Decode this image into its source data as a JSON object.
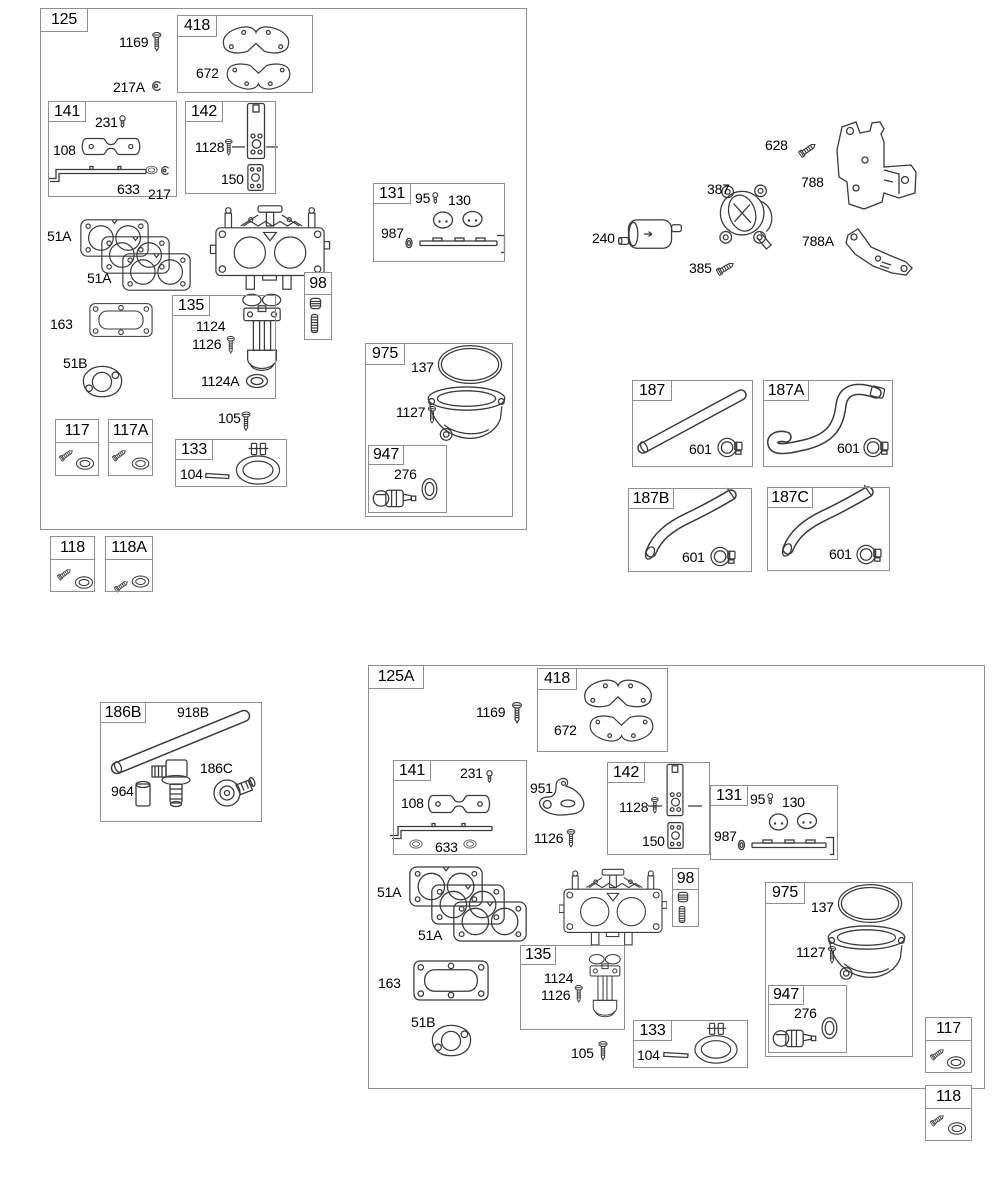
{
  "colors": {
    "background": "#ffffff",
    "line_art": "#3a3a3a",
    "box_border": "#8f8f8f",
    "text": "#000000"
  },
  "boxes": [
    {
      "id": "125",
      "tag": "125",
      "x": 40,
      "y": 8,
      "w": 487,
      "h": 522,
      "tw": 48,
      "th": 24
    },
    {
      "id": "418-top",
      "tag": "418",
      "x": 177,
      "y": 15,
      "w": 136,
      "h": 78,
      "tw": 40,
      "th": 22
    },
    {
      "id": "141-top",
      "tag": "141",
      "x": 48,
      "y": 101,
      "w": 129,
      "h": 96,
      "tw": 38,
      "th": 21
    },
    {
      "id": "142-top",
      "tag": "142",
      "x": 185,
      "y": 101,
      "w": 91,
      "h": 93,
      "tw": 38,
      "th": 21
    },
    {
      "id": "131-top",
      "tag": "131",
      "x": 373,
      "y": 183,
      "w": 132,
      "h": 79,
      "tw": 38,
      "th": 21
    },
    {
      "id": "98-top",
      "tag": "98",
      "x": 304,
      "y": 272,
      "w": 28,
      "h": 68,
      "th": 23,
      "full": true
    },
    {
      "id": "135-top",
      "tag": "135",
      "x": 172,
      "y": 295,
      "w": 104,
      "h": 104,
      "tw": 38,
      "th": 21
    },
    {
      "id": "975-top",
      "tag": "975",
      "x": 365,
      "y": 343,
      "w": 148,
      "h": 174,
      "tw": 40,
      "th": 22
    },
    {
      "id": "947-top",
      "tag": "947",
      "x": 368,
      "y": 445,
      "w": 79,
      "h": 68,
      "tw": 36,
      "th": 20
    },
    {
      "id": "117-top",
      "tag": "117",
      "x": 55,
      "y": 419,
      "w": 44,
      "h": 57,
      "th": 24,
      "full": true
    },
    {
      "id": "117A-top",
      "tag": "117A",
      "x": 108,
      "y": 419,
      "w": 45,
      "h": 57,
      "th": 24,
      "full": true
    },
    {
      "id": "133-top",
      "tag": "133",
      "x": 175,
      "y": 439,
      "w": 112,
      "h": 48,
      "tw": 38,
      "th": 21
    },
    {
      "id": "118-left",
      "tag": "118",
      "x": 50,
      "y": 536,
      "w": 45,
      "h": 56,
      "th": 24,
      "full": true
    },
    {
      "id": "118A-left",
      "tag": "118A",
      "x": 105,
      "y": 536,
      "w": 48,
      "h": 56,
      "th": 24,
      "full": true
    },
    {
      "id": "187",
      "tag": "187",
      "x": 632,
      "y": 380,
      "w": 121,
      "h": 87,
      "tw": 40,
      "th": 21
    },
    {
      "id": "187A",
      "tag": "187A",
      "x": 763,
      "y": 380,
      "w": 130,
      "h": 87,
      "tw": 46,
      "th": 21
    },
    {
      "id": "187B",
      "tag": "187B",
      "x": 628,
      "y": 488,
      "w": 124,
      "h": 84,
      "tw": 46,
      "th": 21
    },
    {
      "id": "187C",
      "tag": "187C",
      "x": 767,
      "y": 487,
      "w": 123,
      "h": 84,
      "tw": 46,
      "th": 21
    },
    {
      "id": "186B",
      "tag": "186B",
      "x": 100,
      "y": 702,
      "w": 162,
      "h": 120,
      "tw": 46,
      "th": 21
    },
    {
      "id": "125A",
      "tag": "125A",
      "x": 368,
      "y": 665,
      "w": 617,
      "h": 424,
      "tw": 56,
      "th": 24
    },
    {
      "id": "418-bottom",
      "tag": "418",
      "x": 537,
      "y": 668,
      "w": 131,
      "h": 84,
      "tw": 40,
      "th": 22
    },
    {
      "id": "141-bottom",
      "tag": "141",
      "x": 393,
      "y": 760,
      "w": 134,
      "h": 95,
      "tw": 38,
      "th": 21
    },
    {
      "id": "142-bottom",
      "tag": "142",
      "x": 607,
      "y": 762,
      "w": 103,
      "h": 93,
      "tw": 38,
      "th": 21
    },
    {
      "id": "131-bottom",
      "tag": "131",
      "x": 710,
      "y": 785,
      "w": 128,
      "h": 75,
      "tw": 38,
      "th": 21
    },
    {
      "id": "98-bottom",
      "tag": "98",
      "x": 672,
      "y": 868,
      "w": 27,
      "h": 59,
      "th": 22,
      "full": true
    },
    {
      "id": "135-bottom",
      "tag": "135",
      "x": 520,
      "y": 945,
      "w": 105,
      "h": 85,
      "tw": 36,
      "th": 20
    },
    {
      "id": "133-bottom",
      "tag": "133",
      "x": 633,
      "y": 1020,
      "w": 115,
      "h": 48,
      "tw": 39,
      "th": 21
    },
    {
      "id": "975-bottom",
      "tag": "975",
      "x": 765,
      "y": 882,
      "w": 148,
      "h": 175,
      "tw": 40,
      "th": 22
    },
    {
      "id": "947-bottom",
      "tag": "947",
      "x": 768,
      "y": 985,
      "w": 79,
      "h": 68,
      "tw": 36,
      "th": 20
    },
    {
      "id": "117-bottom",
      "tag": "117",
      "x": 925,
      "y": 1017,
      "w": 47,
      "h": 56,
      "th": 24,
      "full": true
    },
    {
      "id": "118-bottom",
      "tag": "118",
      "x": 925,
      "y": 1085,
      "w": 47,
      "h": 56,
      "th": 24,
      "full": true
    }
  ],
  "labels": [
    {
      "part": "1169",
      "x": 119,
      "y": 35
    },
    {
      "part": "217A",
      "x": 113,
      "y": 80
    },
    {
      "part": "672",
      "x": 196,
      "y": 66
    },
    {
      "part": "231",
      "x": 95,
      "y": 115
    },
    {
      "part": "108",
      "x": 53,
      "y": 143
    },
    {
      "part": "633",
      "x": 117,
      "y": 182
    },
    {
      "part": "217",
      "x": 148,
      "y": 187
    },
    {
      "part": "1128",
      "x": 195,
      "y": 140
    },
    {
      "part": "150",
      "x": 221,
      "y": 172
    },
    {
      "part": "95",
      "x": 415,
      "y": 191
    },
    {
      "part": "130",
      "x": 448,
      "y": 193
    },
    {
      "part": "987",
      "x": 381,
      "y": 226
    },
    {
      "part": "51A",
      "x": 47,
      "y": 229
    },
    {
      "part": "51A",
      "x": 87,
      "y": 271
    },
    {
      "part": "163",
      "x": 50,
      "y": 317
    },
    {
      "part": "51B",
      "x": 63,
      "y": 356
    },
    {
      "part": "1124",
      "x": 196,
      "y": 319
    },
    {
      "part": "1126",
      "x": 192,
      "y": 337
    },
    {
      "part": "1124A",
      "x": 201,
      "y": 374
    },
    {
      "part": "105",
      "x": 218,
      "y": 411
    },
    {
      "part": "104",
      "x": 180,
      "y": 467
    },
    {
      "part": "137",
      "x": 411,
      "y": 360
    },
    {
      "part": "1127",
      "x": 396,
      "y": 405
    },
    {
      "part": "276",
      "x": 394,
      "y": 467
    },
    {
      "part": "628",
      "x": 765,
      "y": 138
    },
    {
      "part": "788",
      "x": 801,
      "y": 175
    },
    {
      "part": "387",
      "x": 707,
      "y": 182
    },
    {
      "part": "240",
      "x": 592,
      "y": 231
    },
    {
      "part": "385",
      "x": 689,
      "y": 261
    },
    {
      "part": "788A",
      "x": 802,
      "y": 234
    },
    {
      "part": "601",
      "x": 689,
      "y": 442
    },
    {
      "part": "601",
      "x": 837,
      "y": 441
    },
    {
      "part": "601",
      "x": 682,
      "y": 550
    },
    {
      "part": "601",
      "x": 829,
      "y": 547
    },
    {
      "part": "918B",
      "x": 177,
      "y": 705
    },
    {
      "part": "964",
      "x": 111,
      "y": 784
    },
    {
      "part": "186C",
      "x": 200,
      "y": 761
    },
    {
      "part": "1169",
      "x": 476,
      "y": 705
    },
    {
      "part": "672",
      "x": 554,
      "y": 723
    },
    {
      "part": "231",
      "x": 460,
      "y": 766
    },
    {
      "part": "108",
      "x": 401,
      "y": 796
    },
    {
      "part": "633",
      "x": 435,
      "y": 840
    },
    {
      "part": "951",
      "x": 530,
      "y": 781
    },
    {
      "part": "1126",
      "x": 534,
      "y": 831
    },
    {
      "part": "1128",
      "x": 619,
      "y": 800
    },
    {
      "part": "150",
      "x": 642,
      "y": 834
    },
    {
      "part": "95",
      "x": 750,
      "y": 792
    },
    {
      "part": "130",
      "x": 782,
      "y": 795
    },
    {
      "part": "987",
      "x": 714,
      "y": 829
    },
    {
      "part": "51A",
      "x": 377,
      "y": 885
    },
    {
      "part": "51A",
      "x": 418,
      "y": 928
    },
    {
      "part": "163",
      "x": 378,
      "y": 976
    },
    {
      "part": "51B",
      "x": 411,
      "y": 1015
    },
    {
      "part": "1124",
      "x": 544,
      "y": 971
    },
    {
      "part": "1126",
      "x": 541,
      "y": 988
    },
    {
      "part": "105",
      "x": 571,
      "y": 1046
    },
    {
      "part": "104",
      "x": 637,
      "y": 1048
    },
    {
      "part": "137",
      "x": 811,
      "y": 900
    },
    {
      "part": "1127",
      "x": 796,
      "y": 945
    },
    {
      "part": "276",
      "x": 794,
      "y": 1006
    }
  ]
}
